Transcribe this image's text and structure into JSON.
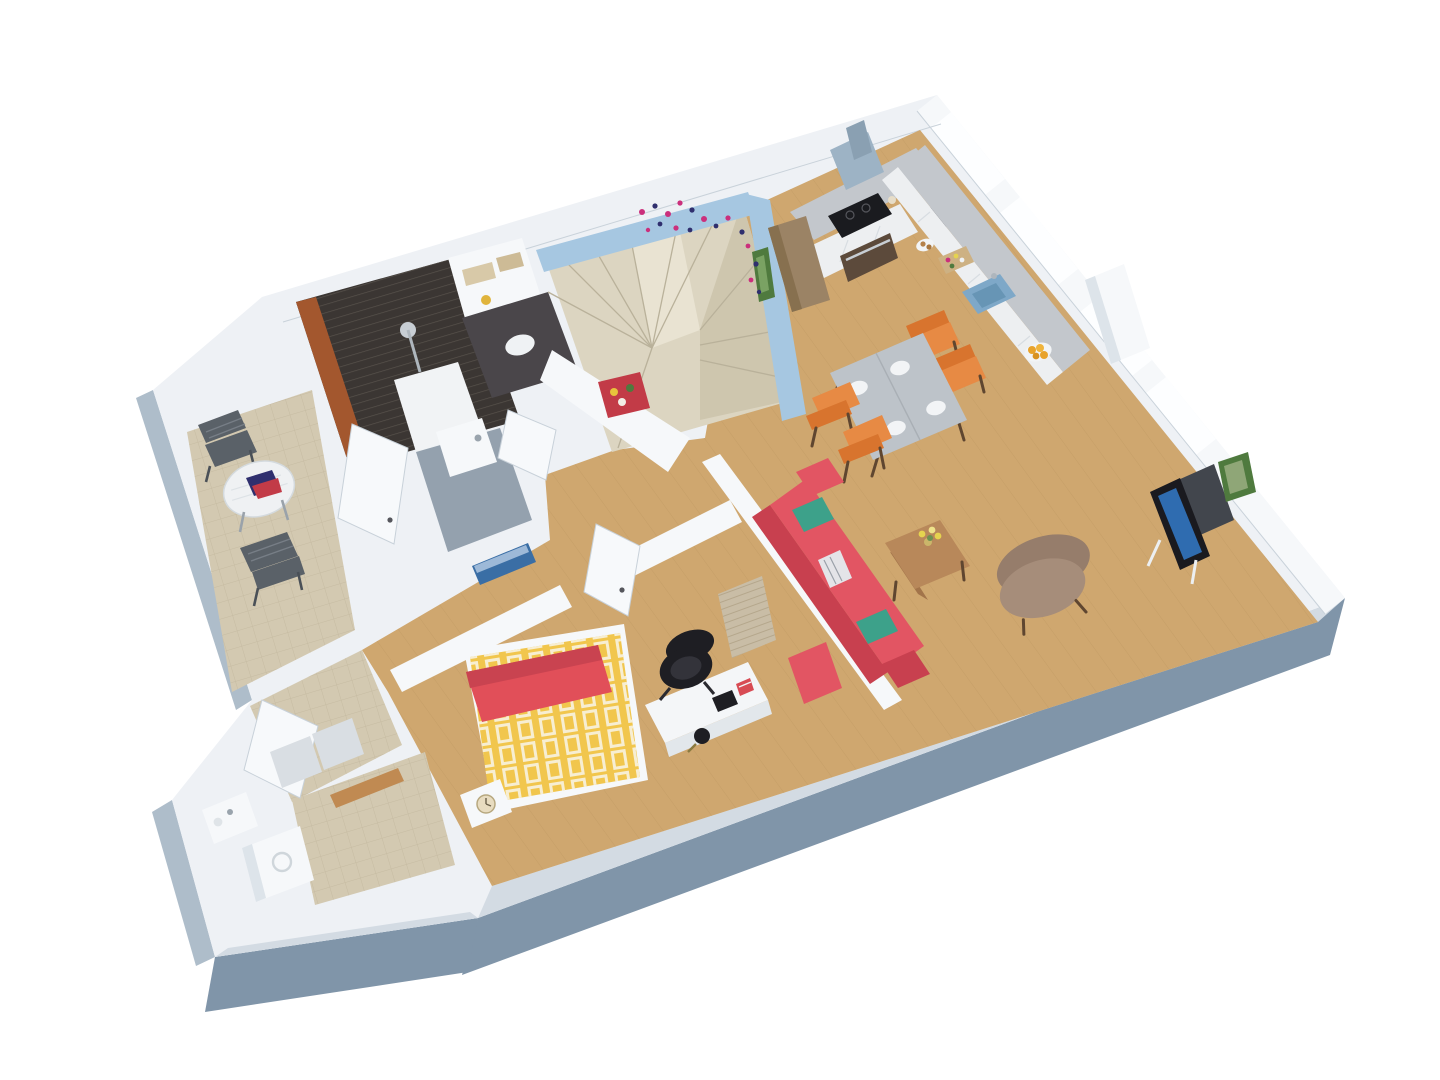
{
  "scene": {
    "kind": "isometric-3d-floor-plan-render",
    "rooms": [
      {
        "name": "terrace",
        "items": [
          "round-bistro-table",
          "folding-chair",
          "folding-chair",
          "magazines"
        ]
      },
      {
        "name": "bathroom",
        "items": [
          "dark-tiled-shower",
          "shower-head",
          "shower-tray",
          "washbasin",
          "vanity",
          "wall-shelf-niche"
        ]
      },
      {
        "name": "staircase",
        "items": [
          "winder-stairs",
          "butterfly-decals",
          "green-poster",
          "flower-poster"
        ]
      },
      {
        "name": "kitchen",
        "items": [
          "range-hood",
          "cooktop",
          "oven",
          "tall-brown-cabinet",
          "counter-left-run",
          "counter-window-run",
          "blue-sink",
          "cutting-board",
          "jars",
          "coffee-maker",
          "fruit-bowl",
          "white-pillar"
        ]
      },
      {
        "name": "dining-area",
        "items": [
          "grey-wood-table",
          "orange-chair",
          "orange-chair",
          "orange-chair",
          "orange-chair",
          "place-setting",
          "place-setting",
          "place-setting",
          "place-setting"
        ]
      },
      {
        "name": "living-room",
        "items": [
          "red-sofa",
          "teal-pillow",
          "teal-pillow",
          "striped-pillow",
          "red-ottoman",
          "coffee-table",
          "flower-vase",
          "fabric-armchair",
          "tv-on-stand",
          "green-picture-frame"
        ]
      },
      {
        "name": "bedroom",
        "items": [
          "double-bed-yellow-duvet",
          "red-blanket-band",
          "nightstand",
          "alarm-clock",
          "white-desk",
          "office-chair",
          "desk-lamp",
          "curtains",
          "seascape-painting"
        ]
      },
      {
        "name": "hallway",
        "items": [
          "tiled-floor",
          "open-door",
          "open-door"
        ]
      },
      {
        "name": "utility-room",
        "items": [
          "washing-machine",
          "small-sink",
          "wooden-threshold",
          "open-door"
        ]
      }
    ],
    "windows": 4,
    "doors_open": 6
  },
  "colors": {
    "background": "#ffffff",
    "wall_top": "#eef1f5",
    "wall_face": "#f6f8fa",
    "wall_shadow": "#dde4ea",
    "cut_light": "#d3dbe3",
    "outer_side_dark": "#8095a9",
    "outer_side_light": "#aebdca",
    "window_glass": "#fdfeff",
    "wood_floor": "#cfa76f",
    "wood_plank_line": "#bd9760",
    "tile_floor": "#d3c9b1",
    "tile_grout": "#c0b59b",
    "stair_tread": "#dcd5c1",
    "stair_shade": "#cec6ae",
    "stair_light": "#e9e3d2",
    "blue_wall": "#a6c7e1",
    "shower_tile_dark": "#3b3633",
    "shower_tile_stripe": "#58524c",
    "shower_frame": "#a3572e",
    "shower_tray": "#f1f3f5",
    "bath_floor": "#94a1ae",
    "counter_top": "#c3c7cc",
    "counter_side": "#b1b6bb",
    "cabinet_front": "#edeff1",
    "hood_steel": "#9db3c5",
    "cooktop": "#1a1b1f",
    "oven_door": "#5c4a3b",
    "tall_cabinet_brown": "#9b8365",
    "sink_blue": "#7ea8c8",
    "dining_table": "#bdc3c9",
    "chair_orange": "#e78a44",
    "chair_orange_dark": "#d8742e",
    "wood_leg": "#5f4630",
    "sofa_red": "#e25563",
    "sofa_dark": "#c8404f",
    "pillow_teal": "#3da18a",
    "coffee_table": "#b8885a",
    "coffee_table_side": "#a2744a",
    "flower_yellow": "#e5d34f",
    "armchair": "#a68d7a",
    "armchair_dark": "#967d6b",
    "tv_black": "#1a1a1f",
    "tv_screen": "#2f6cb0",
    "tv_cabinet": "#42464d",
    "bed_yellow": "#f1c64d",
    "bed_pattern": "#f7eed2",
    "bed_band_red": "#e14f59",
    "desk_white": "#f4f6f8",
    "desk_side": "#e2e7eb",
    "office_chair": "#1e1e23",
    "curtain": "#c9bda6",
    "door_white": "#f7f9fb",
    "door_grey": "#d9dee3",
    "door_edge": "#c8d1d9",
    "terrace_chair": "#5a6168",
    "terrace_table": "#eff1f3",
    "poster_green": "#4f7a3e",
    "poster_red": "#c23b47",
    "painting_blue": "#3a6ea5",
    "butterfly_pink": "#cb2f7c",
    "butterfly_navy": "#2f2f6e",
    "clock_face": "#e8dcc0"
  }
}
